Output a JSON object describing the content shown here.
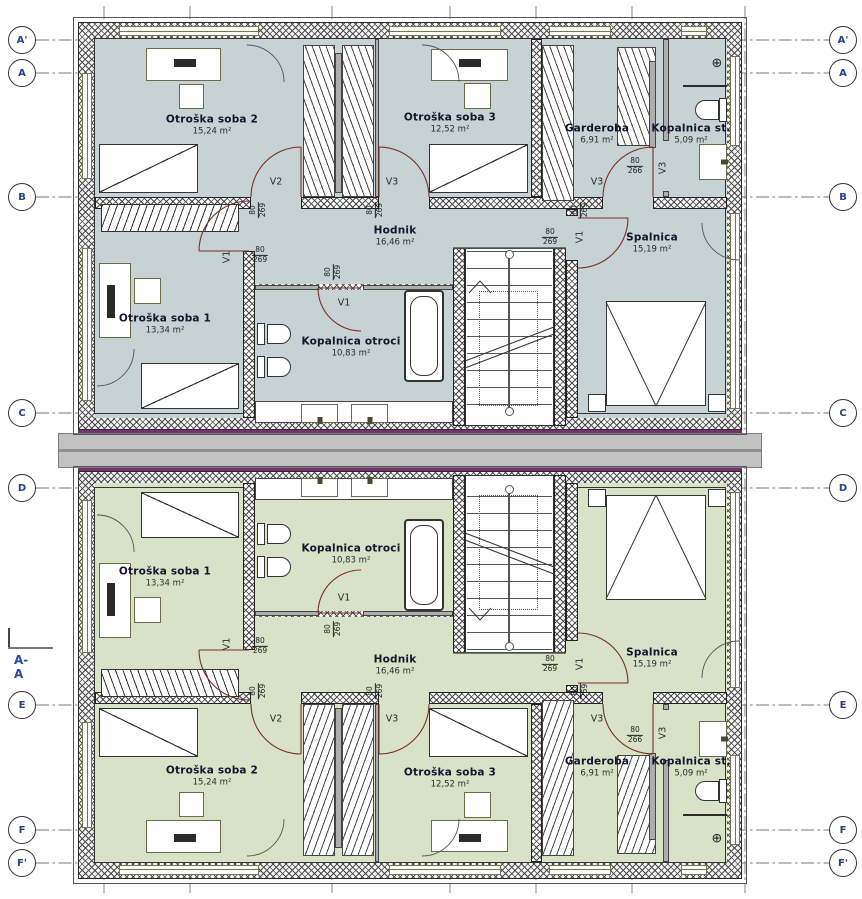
{
  "plan": {
    "section_label": "A-A",
    "grid_rows": [
      "A'",
      "A",
      "B",
      "C",
      "D",
      "E",
      "F",
      "F'"
    ],
    "icons": {
      "fan": "⊕"
    },
    "rooms": {
      "soba2": {
        "name": "Otroška soba 2",
        "area": "15,24 m²"
      },
      "soba3": {
        "name": "Otroška soba 3",
        "area": "12,52 m²"
      },
      "garderoba": {
        "name": "Garderoba",
        "area": "6,91 m²"
      },
      "kopalnica_st": {
        "name": "Kopalnica st.",
        "area": "5,09 m²"
      },
      "hodnik": {
        "name": "Hodnik",
        "area": "16,46 m²"
      },
      "spalnica": {
        "name": "Spalnica",
        "area": "15,19 m²"
      },
      "soba1": {
        "name": "Otroška soba 1",
        "area": "13,34 m²"
      },
      "kopalnica_otroci": {
        "name": "Kopalnica otroci",
        "area": "10,83 m²"
      }
    },
    "doors": {
      "v1": "V1",
      "v2": "V2",
      "v3": "V3"
    },
    "dims": {
      "d269": {
        "w": "80",
        "h": "269"
      },
      "d266": {
        "w": "80",
        "h": "266"
      }
    },
    "colors": {
      "upper_unit_fill": "#c6d2d4",
      "lower_unit_fill": "#d7e2c7",
      "door_swing": "#7b2d26",
      "party_wall_line": "#7a2f72",
      "grid_letter": "#27408b"
    }
  }
}
